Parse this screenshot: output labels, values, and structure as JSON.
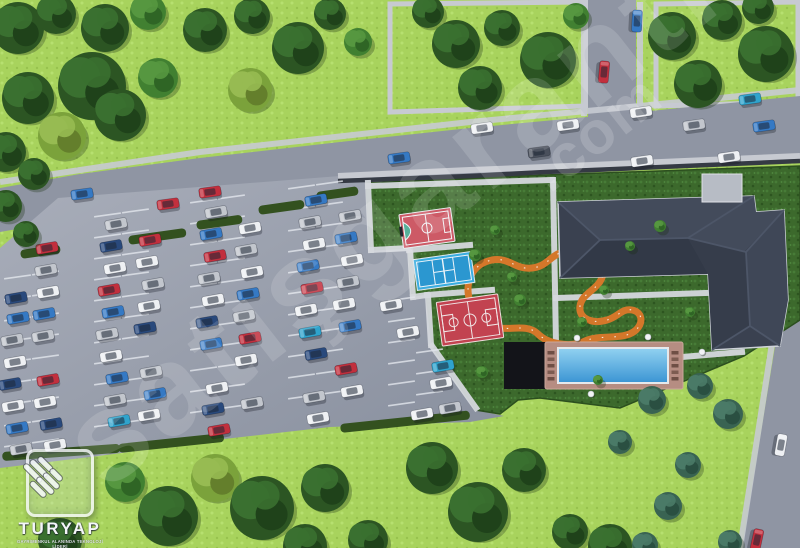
{
  "meta": {
    "title": "aerial-site-plan-render",
    "width": 800,
    "height": 548
  },
  "watermark": {
    "main": "satışgaranti",
    "suffix": ".com"
  },
  "logo": {
    "brand": "TURYAP",
    "tagline": "GAYRİMENKUL ALANINDA TEKNOLOJİ LİDERİ"
  },
  "colors": {
    "grass_light": "#a8d35d",
    "grass_dark": "#3c692c",
    "road": "#8f95a3",
    "sidewalk": "#c7cad1",
    "wall": "#353a44",
    "lot_light": "#a9aeba",
    "lot_dark": "#878e9d",
    "stall_line": "#e2e6ec",
    "hedge": "#33511f",
    "track": "#d4772a",
    "roof": "#3a4150",
    "roof_edge": "#ced2d9",
    "pool_deck": "#b68d82",
    "pool_water_hi": "#8fd0f0",
    "pool_water_lo": "#3d96d4",
    "platform": "#131419"
  },
  "terrain": {
    "road_top": "0,188 80,174 200,158 340,142 470,128 640,112 800,96 800,160 640,170 470,178 340,186 200,202 80,218 0,232",
    "road_vertical": "588,0 636,0 636,113 588,119",
    "road_right": "780,316 800,308 800,548 742,548",
    "lot": "58,198 340,176 366,183 370,250 408,248 412,296 426,294 432,345 436,352 476,410 504,416 470,422 330,427 224,439 114,454 0,468 0,248 28,224",
    "amenity": "366,183 545,175 800,166 800,320 744,356 620,408 540,398 518,400 500,414 476,410 436,352 432,345 426,294 412,296 408,248 370,250",
    "lawn_blocks": [
      "390,4 586,2 586,106 390,112",
      "656,4 798,2 798,102 656,106"
    ],
    "sidewalks": [
      "0,182 200,152 470,122 640,106 800,90",
      "584,2 584,116",
      "640,2 640,108",
      "776,318 740,548"
    ],
    "wall_light": "338,176 470,170 545,167 800,156",
    "wall_dark": "338,181 470,176 545,172 800,161"
  },
  "walkways": [
    "368,183 371,250",
    "371,250 409,248",
    "410,249 413,297",
    "413,297 427,295",
    "428,296 431,345",
    "432,346 476,408",
    "409,250 470,245",
    "427,295 492,290",
    "368,186 552,180",
    "553,180 556,344",
    "556,298 706,293",
    "682,357 742,352"
  ],
  "parking": {
    "stall_columns": [
      {
        "x": 4,
        "y": 278,
        "n": 9
      },
      {
        "x": 32,
        "y": 274,
        "n": 9
      },
      {
        "x": 94,
        "y": 216,
        "n": 11
      },
      {
        "x": 122,
        "y": 212,
        "n": 11
      },
      {
        "x": 190,
        "y": 202,
        "n": 11
      },
      {
        "x": 218,
        "y": 198,
        "n": 11
      },
      {
        "x": 288,
        "y": 188,
        "n": 11
      },
      {
        "x": 316,
        "y": 184,
        "n": 11
      },
      {
        "x": 388,
        "y": 300,
        "n": 6
      },
      {
        "x": 416,
        "y": 352,
        "n": 3
      }
    ],
    "gap": 21,
    "len": 27,
    "angle": -8
  },
  "vehicles": {
    "palette": {
      "w": "#eef0f3",
      "s": "#c2c6cd",
      "r": "#c22f3d",
      "b": "#3579c4",
      "n": "#29497c",
      "t": "#2fa3cc",
      "d": "#4a505c"
    },
    "lot_angle": -10,
    "cars": [
      [
        16,
        298,
        "n"
      ],
      [
        18,
        318,
        "b"
      ],
      [
        12,
        340,
        "s"
      ],
      [
        15,
        362,
        "w"
      ],
      [
        10,
        384,
        "n"
      ],
      [
        13,
        406,
        "w"
      ],
      [
        17,
        428,
        "b"
      ],
      [
        21,
        449,
        "s"
      ],
      [
        46,
        270,
        "s"
      ],
      [
        48,
        292,
        "w"
      ],
      [
        44,
        314,
        "b"
      ],
      [
        43,
        336,
        "s"
      ],
      [
        48,
        380,
        "r"
      ],
      [
        45,
        402,
        "w"
      ],
      [
        51,
        424,
        "n"
      ],
      [
        55,
        445,
        "w"
      ],
      [
        116,
        224,
        "s"
      ],
      [
        111,
        246,
        "n"
      ],
      [
        115,
        268,
        "w"
      ],
      [
        109,
        290,
        "r"
      ],
      [
        113,
        312,
        "b"
      ],
      [
        107,
        334,
        "s"
      ],
      [
        111,
        356,
        "w"
      ],
      [
        117,
        378,
        "b"
      ],
      [
        115,
        400,
        "s"
      ],
      [
        119,
        421,
        "t"
      ],
      [
        150,
        240,
        "r"
      ],
      [
        147,
        262,
        "w"
      ],
      [
        153,
        284,
        "s"
      ],
      [
        149,
        306,
        "w"
      ],
      [
        145,
        328,
        "n"
      ],
      [
        151,
        372,
        "s"
      ],
      [
        155,
        394,
        "b"
      ],
      [
        149,
        415,
        "w"
      ],
      [
        216,
        212,
        "s"
      ],
      [
        211,
        234,
        "b"
      ],
      [
        215,
        256,
        "r"
      ],
      [
        209,
        278,
        "s"
      ],
      [
        213,
        300,
        "w"
      ],
      [
        207,
        322,
        "n"
      ],
      [
        211,
        344,
        "b"
      ],
      [
        217,
        388,
        "w"
      ],
      [
        213,
        409,
        "n"
      ],
      [
        219,
        430,
        "r"
      ],
      [
        250,
        228,
        "w"
      ],
      [
        246,
        250,
        "s"
      ],
      [
        252,
        272,
        "w"
      ],
      [
        248,
        294,
        "b"
      ],
      [
        244,
        316,
        "s"
      ],
      [
        250,
        338,
        "r"
      ],
      [
        246,
        360,
        "w"
      ],
      [
        252,
        403,
        "s"
      ],
      [
        316,
        200,
        "b"
      ],
      [
        310,
        222,
        "s"
      ],
      [
        314,
        244,
        "w"
      ],
      [
        308,
        266,
        "b"
      ],
      [
        312,
        288,
        "r"
      ],
      [
        306,
        310,
        "w"
      ],
      [
        310,
        332,
        "t"
      ],
      [
        316,
        354,
        "n"
      ],
      [
        314,
        397,
        "s"
      ],
      [
        318,
        418,
        "w"
      ],
      [
        350,
        216,
        "s"
      ],
      [
        346,
        238,
        "b"
      ],
      [
        352,
        260,
        "w"
      ],
      [
        348,
        282,
        "s"
      ],
      [
        344,
        304,
        "w"
      ],
      [
        350,
        326,
        "b"
      ],
      [
        346,
        369,
        "r"
      ],
      [
        352,
        391,
        "w"
      ],
      [
        391,
        305,
        "w"
      ],
      [
        408,
        332,
        "w"
      ],
      [
        443,
        366,
        "t"
      ],
      [
        441,
        383,
        "w"
      ],
      [
        450,
        408,
        "s"
      ],
      [
        422,
        414,
        "w"
      ],
      [
        47,
        248,
        "r"
      ]
    ],
    "road_cars": [
      [
        82,
        194,
        "b",
        -8
      ],
      [
        168,
        204,
        "r",
        -8
      ],
      [
        210,
        192,
        "r",
        -8
      ],
      [
        399,
        158,
        "b",
        -8
      ],
      [
        482,
        128,
        "w",
        -8
      ],
      [
        539,
        152,
        "d",
        -8
      ],
      [
        568,
        125,
        "w",
        -8
      ],
      [
        641,
        112,
        "w",
        -8
      ],
      [
        694,
        125,
        "s",
        -8
      ],
      [
        764,
        126,
        "b",
        -8
      ],
      [
        642,
        161,
        "w",
        -8
      ],
      [
        729,
        157,
        "w",
        -8
      ],
      [
        750,
        99,
        "t",
        -8
      ],
      [
        604,
        72,
        "r",
        95
      ],
      [
        637,
        21,
        "b",
        93
      ],
      [
        781,
        445,
        "w",
        100
      ],
      [
        757,
        540,
        "r",
        102
      ]
    ]
  },
  "hedges": [
    {
      "x": 128,
      "y": 236,
      "w": 58,
      "rot": -8
    },
    {
      "x": 196,
      "y": 221,
      "w": 46,
      "rot": -8
    },
    {
      "x": 258,
      "y": 206,
      "w": 46,
      "rot": -8
    },
    {
      "x": 316,
      "y": 192,
      "w": 42,
      "rot": -8
    },
    {
      "x": 2,
      "y": 452,
      "w": 118,
      "rot": -4
    },
    {
      "x": 118,
      "y": 444,
      "w": 106,
      "rot": -6
    },
    {
      "x": 340,
      "y": 424,
      "w": 130,
      "rot": -6
    },
    {
      "x": 20,
      "y": 250,
      "w": 40,
      "rot": -8
    }
  ],
  "track": {
    "d": "M470,302 C464,282 472,264 492,260 C510,257 515,270 532,268 C550,266 550,252 570,251 C592,250 606,258 603,274 C600,290 582,292 580,306 C578,320 594,324 607,320 C618,317 622,308 632,310 C642,312 644,322 636,330 C624,341 600,334 585,341 C570,348 548,344 538,334 C528,324 512,330 498,328 C482,326 472,316 470,302 Z"
  },
  "courts": {
    "futsal": {
      "cx": 427,
      "cy": 228,
      "w": 52,
      "h": 34,
      "rot": -8,
      "fill": "#cd5a66",
      "line": "#f2f5f7",
      "d_fill": "#57b09a"
    },
    "tennis": {
      "cx": 444,
      "cy": 271,
      "w": 58,
      "h": 31,
      "rot": -8,
      "fill": "#3aade0",
      "inner": "#2b97d0",
      "line": "#eef4f8"
    },
    "basketball": {
      "cx": 470,
      "cy": 320,
      "w": 62,
      "h": 44,
      "rot": -8,
      "fill": "#c24350",
      "line": "#f0e6e6"
    }
  },
  "pool": {
    "platform": {
      "x": 504,
      "y": 342,
      "w": 42,
      "h": 47
    },
    "deck": {
      "x": 545,
      "y": 342,
      "w": 138,
      "h": 47
    },
    "coping": {
      "x": 557,
      "y": 347,
      "w": 112,
      "h": 37
    },
    "water": {
      "x": 559,
      "y": 349,
      "w": 108,
      "h": 33
    },
    "lounger_cols": [
      {
        "x": 547.5,
        "y": 351
      },
      {
        "x": 671.5,
        "y": 351
      }
    ],
    "tables": [
      [
        577,
        338
      ],
      [
        648,
        337
      ],
      [
        591,
        394
      ],
      [
        652,
        391
      ],
      [
        702,
        352
      ]
    ]
  },
  "building": {
    "outline": "558,202 754,196 756,212 784,210 788,300 780,346 712,350 708,274 560,278",
    "facets": [
      {
        "points": "558,202 754,196 756,212 784,210 744,252 600,240",
        "fill": "#434b5b"
      },
      {
        "points": "560,278 708,274 688,238 600,240",
        "fill": "#323947"
      },
      {
        "points": "784,210 788,300 780,346 750,326 746,252",
        "fill": "#3f4757"
      },
      {
        "points": "708,274 712,350 750,326 746,252 688,238",
        "fill": "#363d4b"
      }
    ],
    "ridges": [
      [
        600,
        240,
        688,
        238
      ],
      [
        558,
        202,
        600,
        240
      ],
      [
        560,
        278,
        600,
        240
      ],
      [
        754,
        196,
        688,
        238
      ],
      [
        688,
        238,
        746,
        252
      ],
      [
        784,
        210,
        746,
        252
      ],
      [
        746,
        252,
        750,
        326
      ],
      [
        750,
        326,
        780,
        346
      ],
      [
        750,
        326,
        712,
        350
      ]
    ],
    "canopy": {
      "x": 702,
      "y": 174,
      "w": 40,
      "h": 28
    }
  },
  "trees": {
    "palette": {
      "d": [
        "#2c5523",
        "#3a7030",
        "#1f421a"
      ],
      "m": [
        "#418031",
        "#569740",
        "#2f6525"
      ],
      "y": [
        "#7ba23b",
        "#97bb52",
        "#647f2c"
      ],
      "b": [
        "#396352",
        "#4a7a67",
        "#2a4f41"
      ]
    },
    "list": [
      [
        18,
        28,
        26,
        "d"
      ],
      [
        56,
        14,
        20,
        "d"
      ],
      [
        105,
        28,
        24,
        "d"
      ],
      [
        148,
        12,
        18,
        "m"
      ],
      [
        92,
        86,
        34,
        "d"
      ],
      [
        28,
        98,
        26,
        "d"
      ],
      [
        120,
        115,
        26,
        "d"
      ],
      [
        62,
        136,
        24,
        "y"
      ],
      [
        158,
        78,
        20,
        "m"
      ],
      [
        205,
        30,
        22,
        "d"
      ],
      [
        252,
        16,
        18,
        "d"
      ],
      [
        298,
        48,
        26,
        "d"
      ],
      [
        250,
        90,
        22,
        "y"
      ],
      [
        330,
        14,
        16,
        "d"
      ],
      [
        358,
        42,
        14,
        "m"
      ],
      [
        6,
        152,
        20,
        "d"
      ],
      [
        34,
        174,
        16,
        "d"
      ],
      [
        6,
        206,
        16,
        "d"
      ],
      [
        26,
        234,
        13,
        "d"
      ],
      [
        428,
        12,
        16,
        "d"
      ],
      [
        456,
        44,
        24,
        "d"
      ],
      [
        502,
        28,
        18,
        "d"
      ],
      [
        548,
        60,
        28,
        "d"
      ],
      [
        480,
        88,
        22,
        "d"
      ],
      [
        576,
        16,
        13,
        "m"
      ],
      [
        672,
        36,
        24,
        "d"
      ],
      [
        722,
        20,
        20,
        "d"
      ],
      [
        766,
        54,
        28,
        "d"
      ],
      [
        698,
        84,
        24,
        "d"
      ],
      [
        758,
        8,
        16,
        "d"
      ],
      [
        60,
        540,
        22,
        "d"
      ],
      [
        125,
        482,
        20,
        "m"
      ],
      [
        168,
        516,
        30,
        "d"
      ],
      [
        215,
        478,
        24,
        "y"
      ],
      [
        262,
        508,
        32,
        "d"
      ],
      [
        305,
        546,
        22,
        "d"
      ],
      [
        325,
        488,
        24,
        "d"
      ],
      [
        368,
        540,
        20,
        "d"
      ],
      [
        432,
        468,
        26,
        "d"
      ],
      [
        478,
        512,
        30,
        "d"
      ],
      [
        524,
        470,
        22,
        "d"
      ],
      [
        570,
        532,
        18,
        "d"
      ],
      [
        610,
        546,
        22,
        "d"
      ],
      [
        652,
        400,
        14,
        "b"
      ],
      [
        700,
        386,
        13,
        "b"
      ],
      [
        728,
        414,
        15,
        "b"
      ],
      [
        688,
        465,
        13,
        "b"
      ],
      [
        668,
        506,
        14,
        "b"
      ],
      [
        645,
        545,
        13,
        "b"
      ],
      [
        730,
        542,
        12,
        "b"
      ],
      [
        620,
        442,
        12,
        "b"
      ],
      [
        475,
        255,
        6,
        "m"
      ],
      [
        512,
        277,
        5,
        "m"
      ],
      [
        604,
        290,
        5,
        "m"
      ],
      [
        582,
        322,
        5,
        "m"
      ],
      [
        630,
        246,
        5,
        "m"
      ],
      [
        660,
        226,
        6,
        "m"
      ],
      [
        690,
        312,
        5,
        "m"
      ],
      [
        482,
        372,
        6,
        "m"
      ],
      [
        520,
        300,
        6,
        "m"
      ],
      [
        598,
        380,
        5,
        "m"
      ],
      [
        495,
        230,
        5,
        "m"
      ]
    ]
  }
}
